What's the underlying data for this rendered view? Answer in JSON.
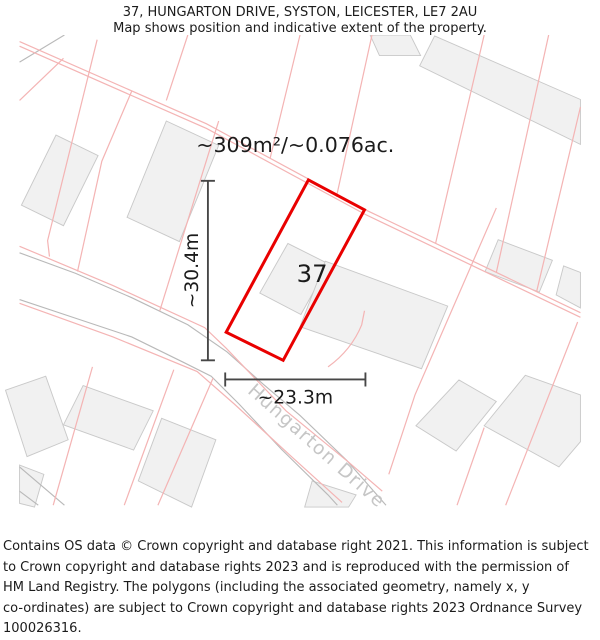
{
  "header": {
    "title_line1": "37, HUNGARTON DRIVE, SYSTON, LEICESTER, LE7 2AU",
    "title_line2": "Map shows position and indicative extent of the property."
  },
  "map": {
    "area_label": "~309m²/~0.076ac.",
    "plot_number": "37",
    "dim_vertical_label": "~30.4m",
    "dim_horizontal_label": "~23.3m",
    "road_name": "Hungarton Drive"
  },
  "footer": {
    "lines": [
      "Contains OS data © Crown copyright and database right 2021. This information is subject",
      "to Crown copyright and database rights 2023 and is reproduced with the permission of",
      "HM Land Registry. The polygons (including the associated geometry, namely x, y",
      "co-ordinates) are subject to Crown copyright and database rights 2023 Ordnance Survey",
      "100026316."
    ]
  },
  "colors": {
    "plot-red": "#e90000",
    "parcel-pink": "#f4b4b4",
    "building-fill": "#f1f1f1",
    "building-stroke": "#c9c9c9",
    "road-gray": "#b9b9b9",
    "dim-gray": "#474747",
    "road-label-gray": "#c6c6c6",
    "text-dark": "#1b1b1b"
  }
}
